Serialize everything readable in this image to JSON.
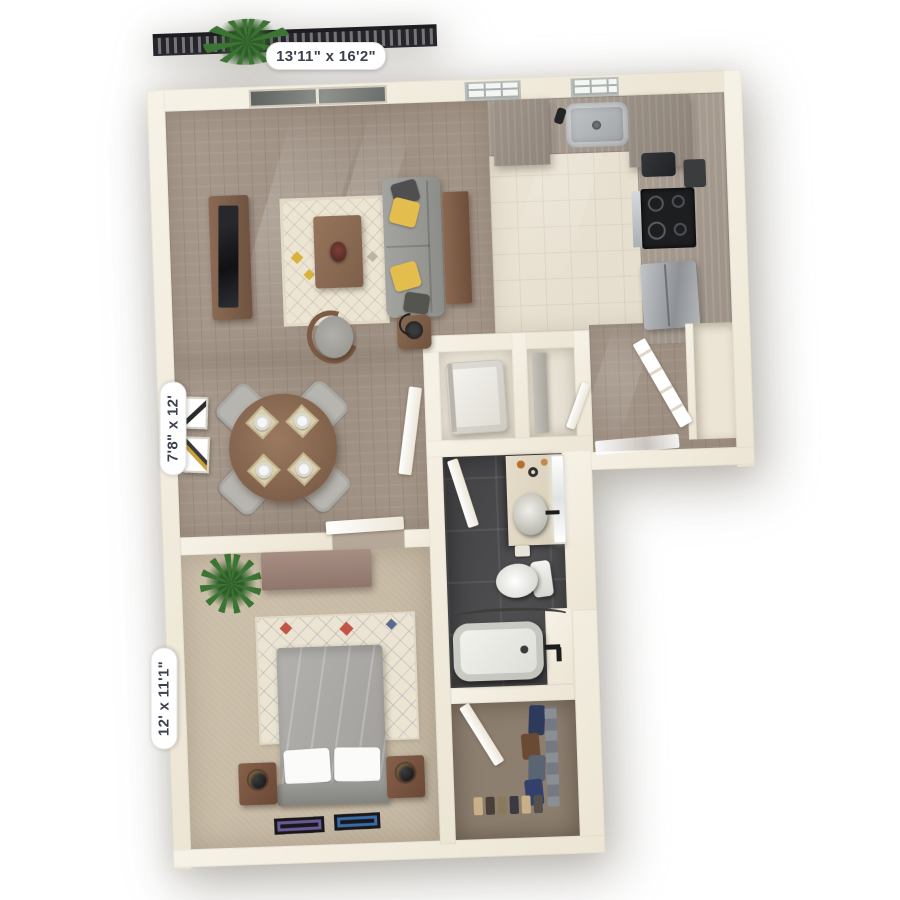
{
  "scene": {
    "type": "3d-floor-plan-render",
    "view": "top-down apartment"
  },
  "background": "#ffffff",
  "dimension_labels": {
    "living_room": {
      "text": "13'11\" x 16'2\""
    },
    "dining_area": {
      "text": "7'8\" x 12'"
    },
    "bedroom": {
      "text": "12' x 11'1\""
    }
  },
  "palette": {
    "wall": "#f2ecdf",
    "wood_floor": "#a29486",
    "kitchen_tile": "#e7e0d1",
    "bathroom_tile": "#4b4b4d",
    "bedroom_carpet": "#c9bca7",
    "closet_carpet": "#8d7f70",
    "cabinet_wood": "#a79c90",
    "sofa_gray": "#9c9c98",
    "accent_yellow": "#e3bd4e",
    "furniture_wood": "#7b5c49",
    "railing": "#26262a",
    "label_text": "#3b414d"
  },
  "rooms": [
    {
      "name": "balcony",
      "items": [
        "railing",
        "potted-plant"
      ]
    },
    {
      "name": "living-room",
      "floor": "hardwood",
      "items": [
        "sliding-glass-door",
        "tv-console",
        "tv",
        "area-rug",
        "coffee-table",
        "decor-vase",
        "sofa",
        "throw-pillows",
        "console-table",
        "accent-chair",
        "side-table",
        "lamp"
      ]
    },
    {
      "name": "dining-area",
      "floor": "hardwood",
      "items": [
        "round-table",
        "four-chairs",
        "four-place-settings",
        "wall-art-frames"
      ]
    },
    {
      "name": "kitchen",
      "floor": "tile",
      "items": [
        "windows",
        "sink",
        "faucet",
        "upper-cabinets",
        "l-shaped-counter",
        "stove",
        "toaster",
        "refrigerator"
      ]
    },
    {
      "name": "entry",
      "floor": "hardwood",
      "items": [
        "front-door",
        "door-mat",
        "storage-niche"
      ]
    },
    {
      "name": "laundry-closet",
      "items": [
        "washer-dryer",
        "door"
      ]
    },
    {
      "name": "utility-closet",
      "items": [
        "shelving-panel",
        "door"
      ]
    },
    {
      "name": "bathroom",
      "floor": "dark-tile",
      "items": [
        "vanity",
        "vessel-sink",
        "mirror",
        "toiletries",
        "toilet",
        "toilet-paper-holder",
        "bathtub",
        "shower-rod",
        "tub-faucet",
        "door"
      ]
    },
    {
      "name": "walk-in-closet",
      "floor": "carpet",
      "items": [
        "hanging-clothes",
        "shoe-row",
        "door"
      ]
    },
    {
      "name": "bedroom",
      "floor": "carpet",
      "items": [
        "bed",
        "duvet",
        "pillows",
        "headboard",
        "nightstands",
        "lamps",
        "dresser",
        "potted-plant",
        "area-rug",
        "picture-frames",
        "door"
      ]
    }
  ]
}
